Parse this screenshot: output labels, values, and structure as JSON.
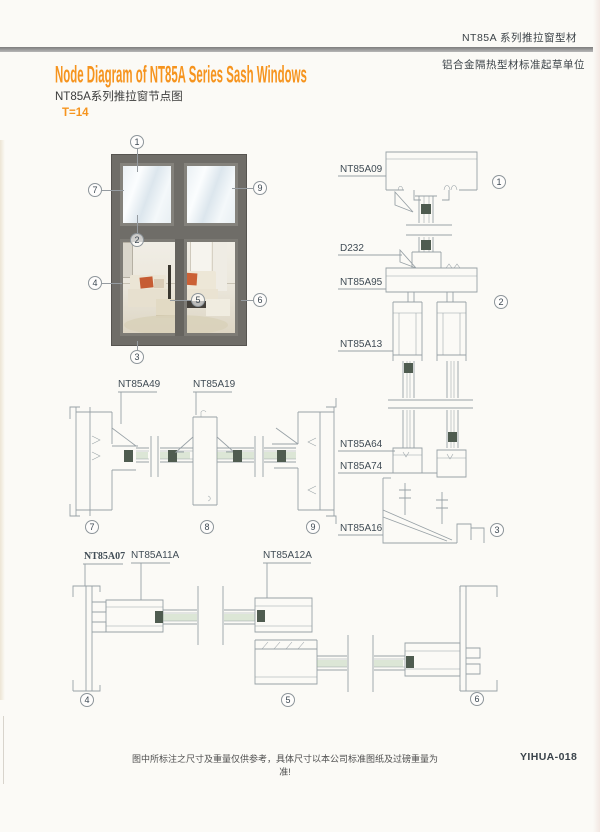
{
  "header": {
    "series_label": "NT85A 系列推拉窗型材",
    "org_label": "铝合金隔热型材标准起草单位",
    "title_en": "Node Diagram of NT85A Series Sash Windows",
    "title_cn": "NT85A系列推拉窗节点图",
    "thickness": "T=14"
  },
  "callouts": {
    "c1": "1",
    "c2": "2",
    "c3": "3",
    "c4": "4",
    "c5": "5",
    "c6": "6",
    "c7": "7",
    "c8": "8",
    "c9": "9"
  },
  "profiles": {
    "vertical": [
      "NT85A09",
      "D232",
      "NT85A95",
      "NT85A13",
      "NT85A64",
      "NT85A74",
      "NT85A16"
    ],
    "middle": [
      "NT85A49",
      "NT85A19"
    ],
    "bottom": [
      "NT85A07",
      "NT85A11A",
      "NT85A12A"
    ]
  },
  "footer": {
    "disclaimer": "图中所标注之尺寸及重量仅供参考，具体尺寸以本公司标准图纸及过磅重量为准!",
    "code": "YIHUA-018"
  },
  "colors": {
    "accent": "#f6941e",
    "line": "#98a1a6",
    "frame": "#6f6d68",
    "bar": "#8c8c8c"
  }
}
